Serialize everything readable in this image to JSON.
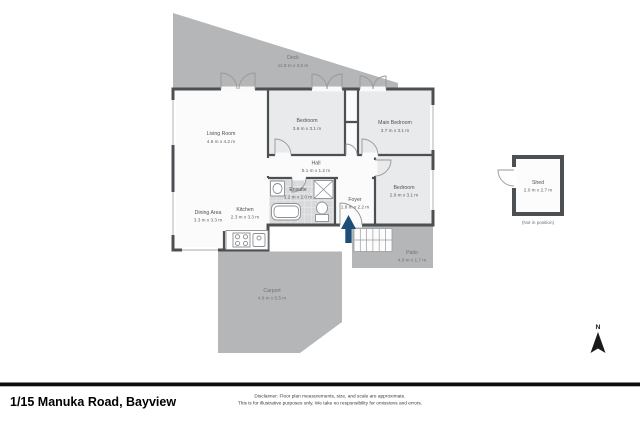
{
  "footer": {
    "title": "1/15 Manuka Road, Bayview",
    "disclaimer_line1": "Disclaimer: Floor plan measurements, size, and scale are approximate.",
    "disclaimer_line2": "This is for illustrative purposes only. We take no responsibility for omissions and errors."
  },
  "compass": {
    "label": "N"
  },
  "shed": {
    "note": "(Not in position)"
  },
  "rooms": [
    {
      "name": "Deck",
      "dims": "11.8 m x 3.6 m"
    },
    {
      "name": "Living Room",
      "dims": "4.6 m x 4.2 m"
    },
    {
      "name": "Bedroom",
      "dims": "3.6 m x 3.1 m"
    },
    {
      "name": "Main Bedroom",
      "dims": "3.7 m x 3.1 m"
    },
    {
      "name": "Hall",
      "dims": "5.1 m x 1.2 m"
    },
    {
      "name": "Ensuite",
      "dims": "3.2 m x 2.0 m"
    },
    {
      "name": "Foyer",
      "dims": "1.8 m x 2.2 m"
    },
    {
      "name": "Bedroom",
      "dims": "2.9 m x 3.1 m"
    },
    {
      "name": "Dining Area",
      "dims": "3.3 m x 3.3 m"
    },
    {
      "name": "Kitchen",
      "dims": "2.3 m x 3.3 m"
    },
    {
      "name": "Patio",
      "dims": "4.0 m x 1.7 m"
    },
    {
      "name": "Carport",
      "dims": "4.6 m x 5.5 m"
    },
    {
      "name": "Shed",
      "dims": "2.0 m x 2.7 m"
    }
  ],
  "icons": {
    "entry_arrow": "up-arrow-entry-marker",
    "compass": "north-arrow"
  },
  "colors": {
    "outdoor_gray": "#b4b6b8",
    "wall": "#4d5053",
    "room_fill": "#fbfbfc",
    "bedroom_fill": "#e9eaeb",
    "tile_fill": "#d8dadb",
    "entry_arrow": "#1d4e78",
    "footer_bar": "#0d0d0d"
  }
}
